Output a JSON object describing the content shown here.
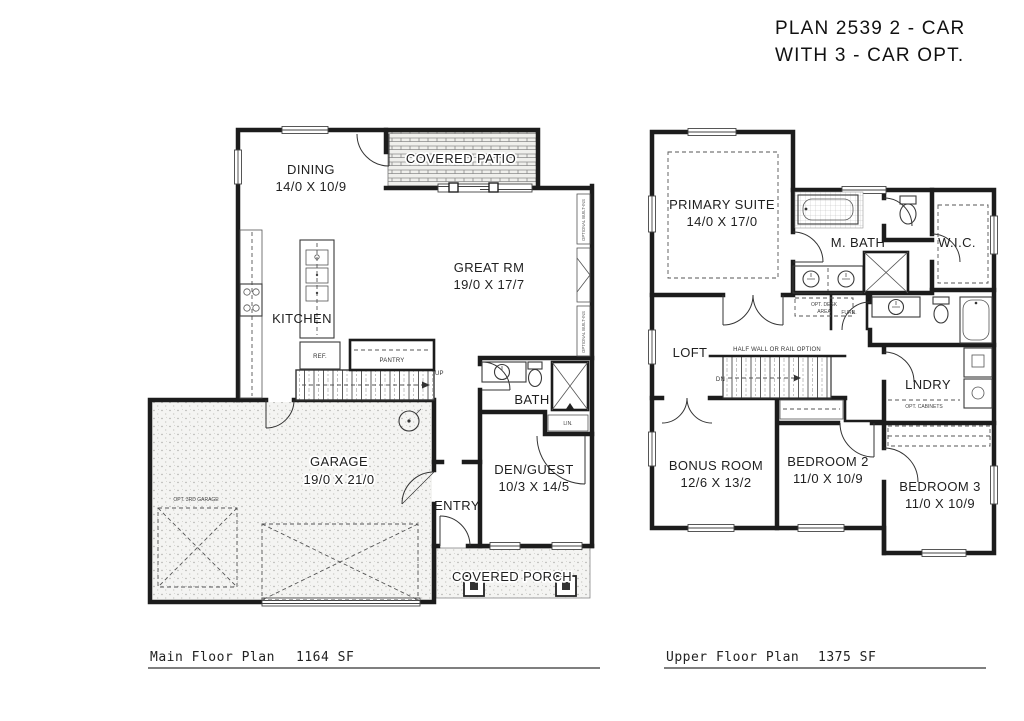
{
  "title": {
    "line1": "PLAN 2539 2 - CAR",
    "line2": "WITH 3 - CAR OPT."
  },
  "main_floor": {
    "caption": "Main Floor Plan",
    "area": "1164 SF",
    "rooms": {
      "dining": {
        "name": "DINING",
        "dims": "14/0 X 10/9"
      },
      "covered_patio": {
        "name": "COVERED PATIO"
      },
      "great_rm": {
        "name": "GREAT RM",
        "dims": "19/0 X 17/7"
      },
      "kitchen": {
        "name": "KITCHEN"
      },
      "bath": {
        "name": "BATH"
      },
      "den_guest": {
        "name": "DEN/GUEST",
        "dims": "10/3 X 14/5"
      },
      "entry": {
        "name": "ENTRY"
      },
      "garage": {
        "name": "GARAGE",
        "dims": "19/0 X 21/0"
      },
      "covered_porch": {
        "name": "COVERED PORCH"
      }
    },
    "annotations": {
      "ref": "REF.",
      "pantry": "PANTRY",
      "up": "UP",
      "lin": "LIN.",
      "opt_3rd_garage": "OPT. 3RD GARAGE",
      "optional_built_ins": "OPTIONAL BUILT-INS"
    }
  },
  "upper_floor": {
    "caption": "Upper Floor Plan",
    "area": "1375 SF",
    "rooms": {
      "primary_suite": {
        "name": "PRIMARY SUITE",
        "dims": "14/0 X 17/0"
      },
      "m_bath": {
        "name": "M. BATH"
      },
      "wic": {
        "name": "W.I.C."
      },
      "loft": {
        "name": "LOFT"
      },
      "lndry": {
        "name": "LNDRY"
      },
      "bonus_room": {
        "name": "BONUS ROOM",
        "dims": "12/6 X 13/2"
      },
      "bedroom2": {
        "name": "BEDROOM 2",
        "dims": "11/0 X 10/9"
      },
      "bedroom3": {
        "name": "BEDROOM 3",
        "dims": "11/0 X 10/9"
      }
    },
    "annotations": {
      "half_wall": "HALF WALL OR RAIL OPTION",
      "dn": "DN",
      "furn": "FURN.",
      "opt_desk_line1": "OPT. DESK",
      "opt_desk_line2": "AREA",
      "opt_cabinets": "OPT. CABINETS"
    }
  },
  "colors": {
    "wall": "#1c1c1c",
    "thin_line": "#444444",
    "label": "#1f1f1f",
    "hatch": "#8a8a8a"
  }
}
